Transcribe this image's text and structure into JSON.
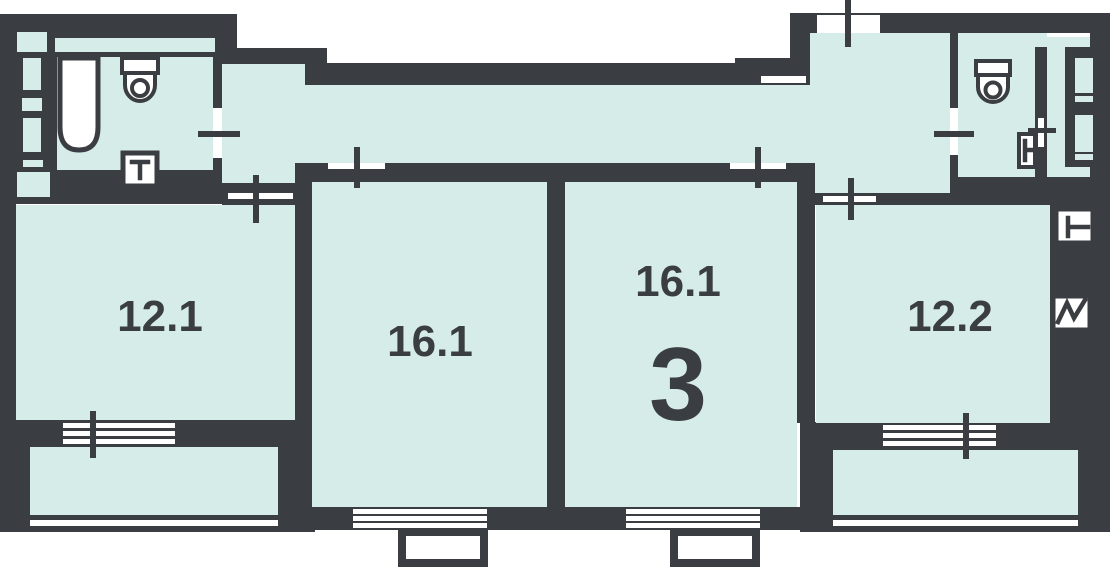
{
  "floorplan": {
    "apartment_rooms_count": "3",
    "rooms": [
      {
        "key": "room_12_1",
        "label": "12.1"
      },
      {
        "key": "room_16_1_left",
        "label": "16.1"
      },
      {
        "key": "room_16_1_right",
        "label": "16.1"
      },
      {
        "key": "room_12_2",
        "label": "12.2"
      }
    ],
    "fixtures": [
      "bathtub-icon",
      "toilet-icon",
      "washbasin-icon",
      "toilet-icon",
      "sink-icon",
      "towel-rail-icon",
      "electrical-zigzag-icon"
    ],
    "markers": [
      "door-cross-marker",
      "balcony-door-marker",
      "window-stripes",
      "entrance-opening"
    ],
    "colors": {
      "wall": "#3a3d41",
      "floor": "#d6ece9",
      "background": "#ffffff",
      "fixture": "#ffffff"
    }
  }
}
